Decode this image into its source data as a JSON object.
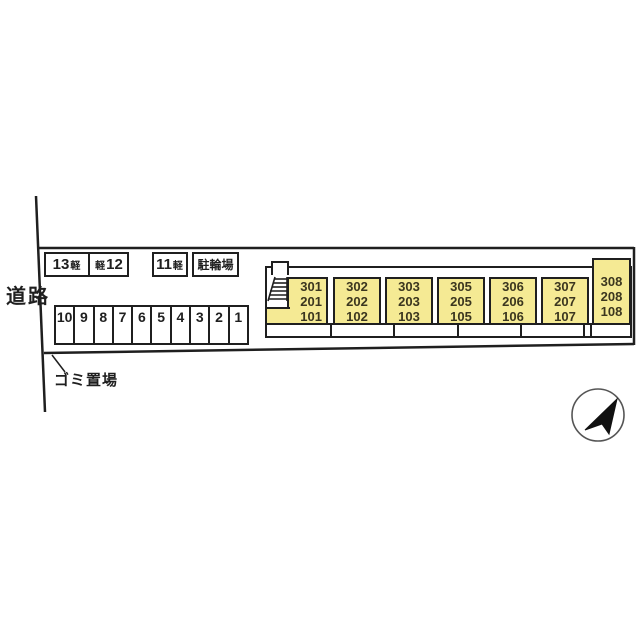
{
  "site": {
    "road_label": "道路",
    "garbage_label": "ゴミ置場"
  },
  "kei_parking": {
    "stall13_num": "13",
    "stall13_suffix": "軽",
    "stall12_prefix": "軽",
    "stall12_num": "12",
    "stall11_num": "11",
    "stall11_suffix": "軽"
  },
  "bicycle_parking_label": "駐輪場",
  "parking_stalls": [
    "10",
    "9",
    "8",
    "7",
    "6",
    "5",
    "4",
    "3",
    "2",
    "1"
  ],
  "building": {
    "units": [
      {
        "f3": "301",
        "f2": "201",
        "f1": "101"
      },
      {
        "f3": "302",
        "f2": "202",
        "f1": "102"
      },
      {
        "f3": "303",
        "f2": "203",
        "f1": "103"
      },
      {
        "f3": "305",
        "f2": "205",
        "f1": "105"
      },
      {
        "f3": "306",
        "f2": "206",
        "f1": "106"
      },
      {
        "f3": "307",
        "f2": "207",
        "f1": "107"
      },
      {
        "f3": "308",
        "f2": "208",
        "f1": "108"
      }
    ]
  },
  "icons": {
    "compass": "north-arrow",
    "stairs": "staircase"
  },
  "colors": {
    "unit_fill": "#f5ea94",
    "line": "#1f1f1f"
  }
}
